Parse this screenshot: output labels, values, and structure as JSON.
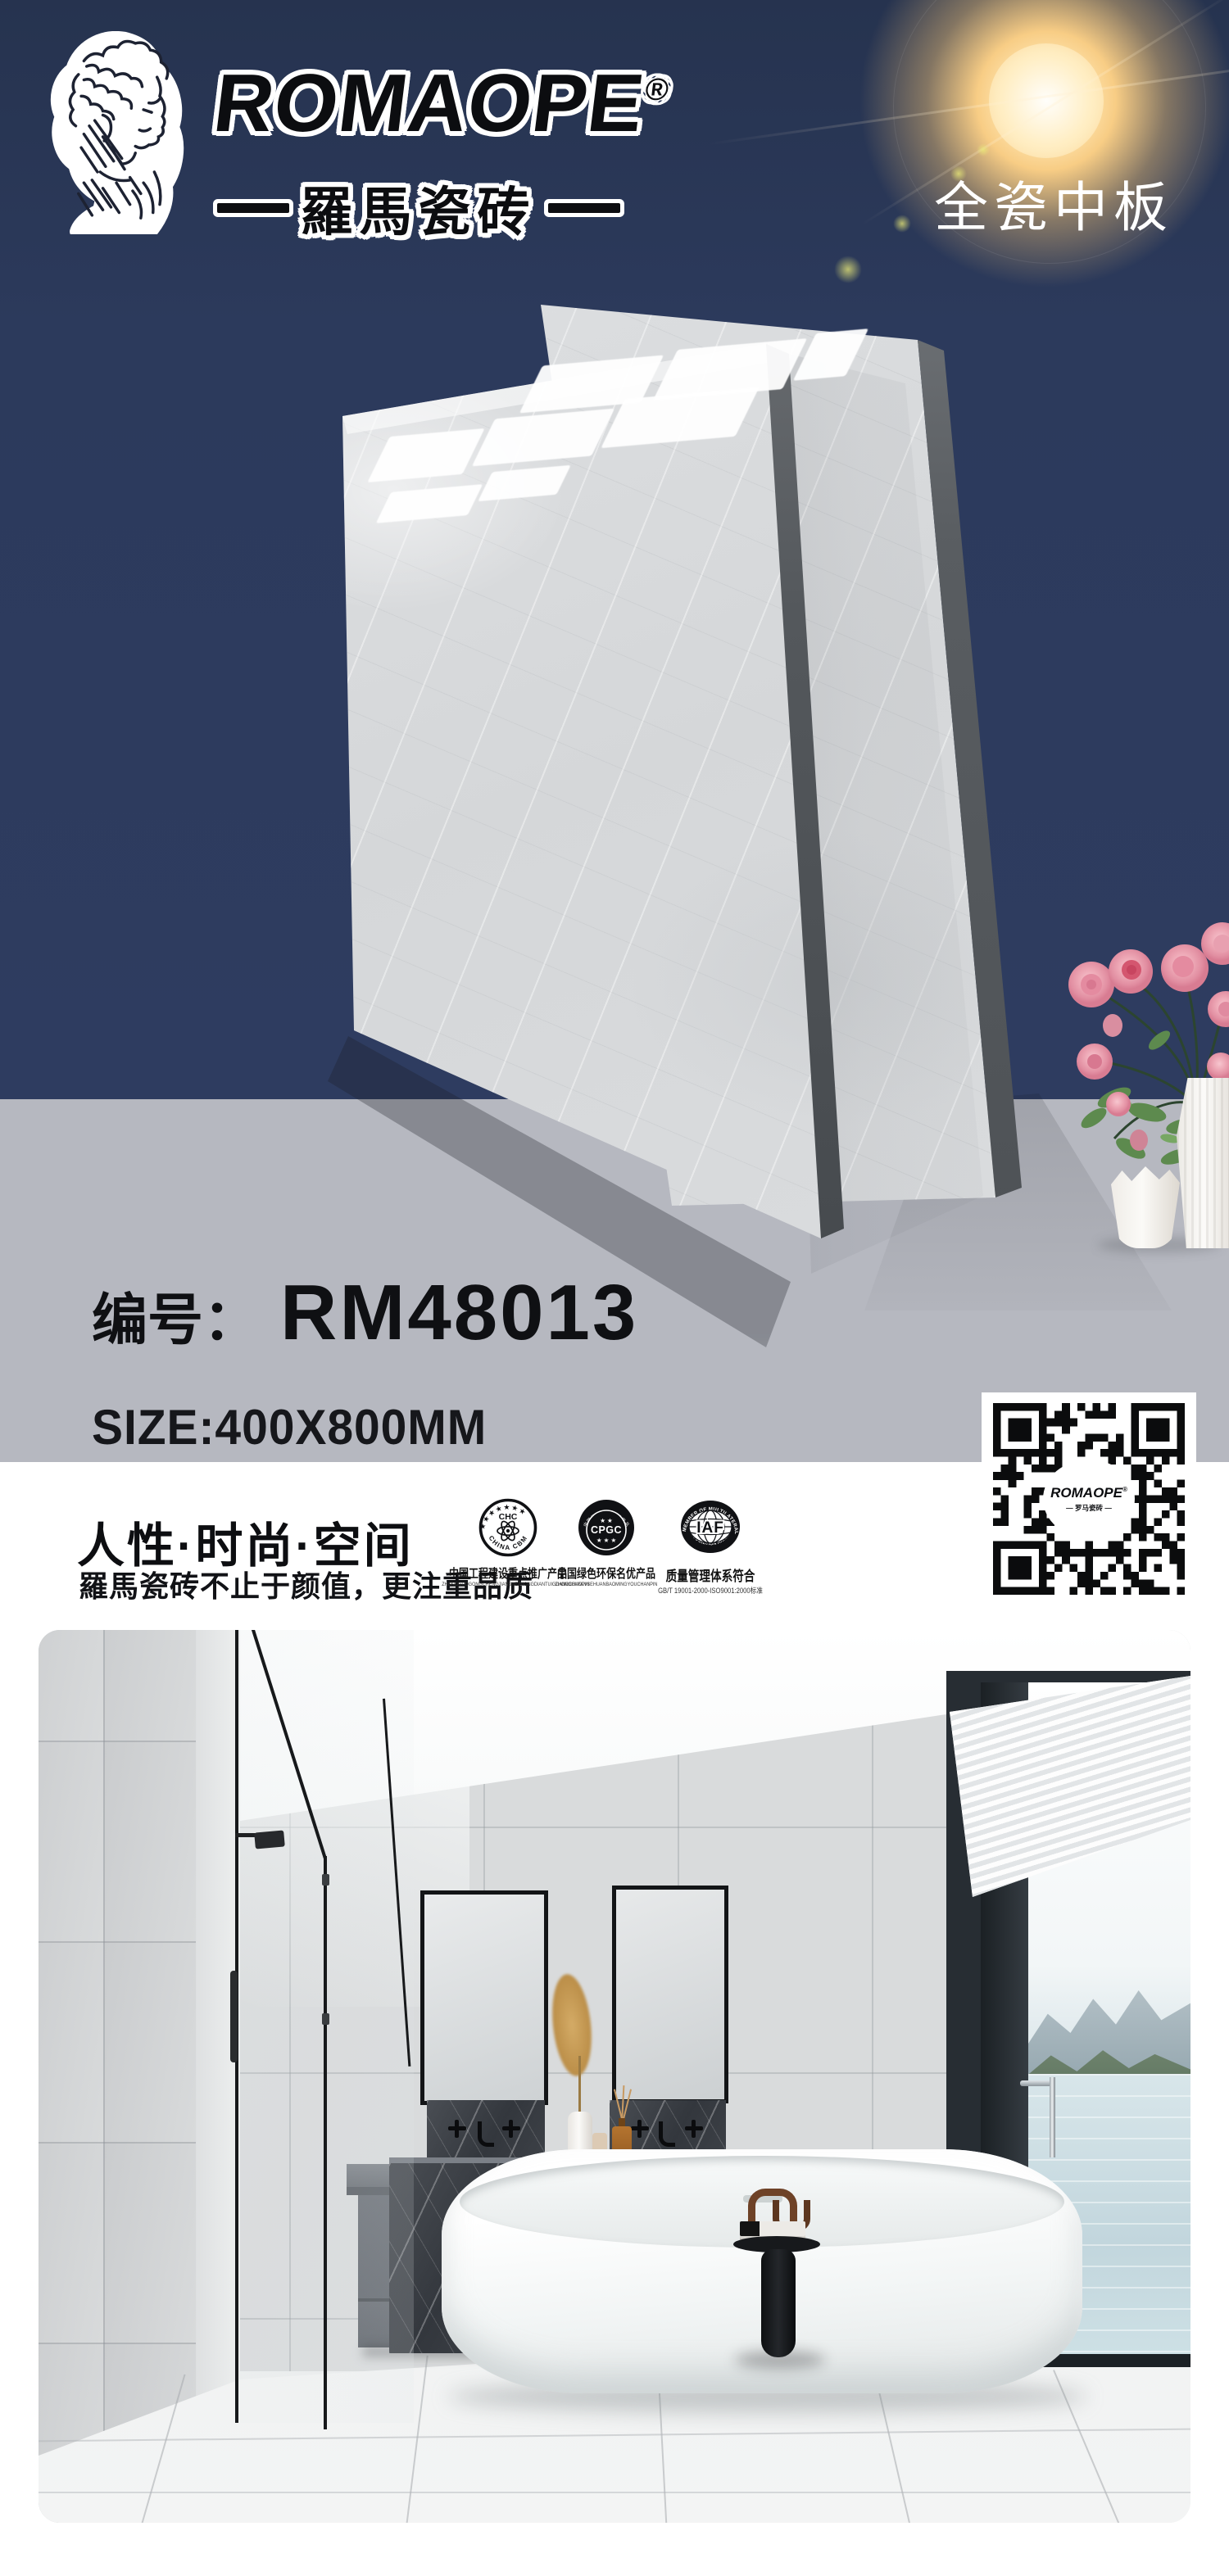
{
  "colors": {
    "navy": "#2c3a5c",
    "band_gray": "#b6b8c0",
    "white": "#ffffff",
    "text_black": "#0f1013",
    "marble_light": "#dcdee0",
    "tile_edge_dark": "#5a5e62",
    "flower_pink": "#eba6b4",
    "leaf_green": "#5d8a4e",
    "sun_gold": "#f6c87d"
  },
  "brand": {
    "wordmark": "ROMAOPE",
    "registered": "®",
    "chinese": "羅馬瓷砖",
    "icon": "david-statue-engraving"
  },
  "header": {
    "product_type": "全瓷中板"
  },
  "product": {
    "code_label": "编号：",
    "code": "RM48013",
    "size": "SIZE:400X800MM"
  },
  "tagline": {
    "heading": "人性·时尚·空间",
    "subheading": "羅馬瓷砖不止于颜值，更注重品质"
  },
  "certifications": [
    {
      "id": "china-cbm",
      "stars": "★★★★★★★",
      "center": "CHC",
      "arc_bottom": "CHINA CBM",
      "caption": "中国工程建设重点推广产品",
      "caption_sub": "ZHONGGUOGONGCHENGJIANSHEZHONGDIANTUIGUANGCHANPIN"
    },
    {
      "id": "cpgc",
      "ring": "中国绿色环保名优产品",
      "stars_top": "★ ★",
      "center": "CPGC",
      "stars_bottom": "★ ★ ★",
      "caption": "中国绿色环保名优产品",
      "caption_sub": "ZHONGGUOLVSEHUANBAOMINGYOUCHANPIN"
    },
    {
      "id": "iaf",
      "arc_top": "MEMBER OF MULTILATERAL",
      "center": "IAF",
      "arc_bottom": "RECOGNITION ARRANGEMENT",
      "caption": "质量管理体系符合",
      "caption_sub": "GB/T 19001-2000-ISO9001:2000标准"
    }
  ],
  "qr": {
    "label": "ROMAOPE",
    "label_registered": "®",
    "label_sub": "— 罗马瓷砖 —"
  }
}
